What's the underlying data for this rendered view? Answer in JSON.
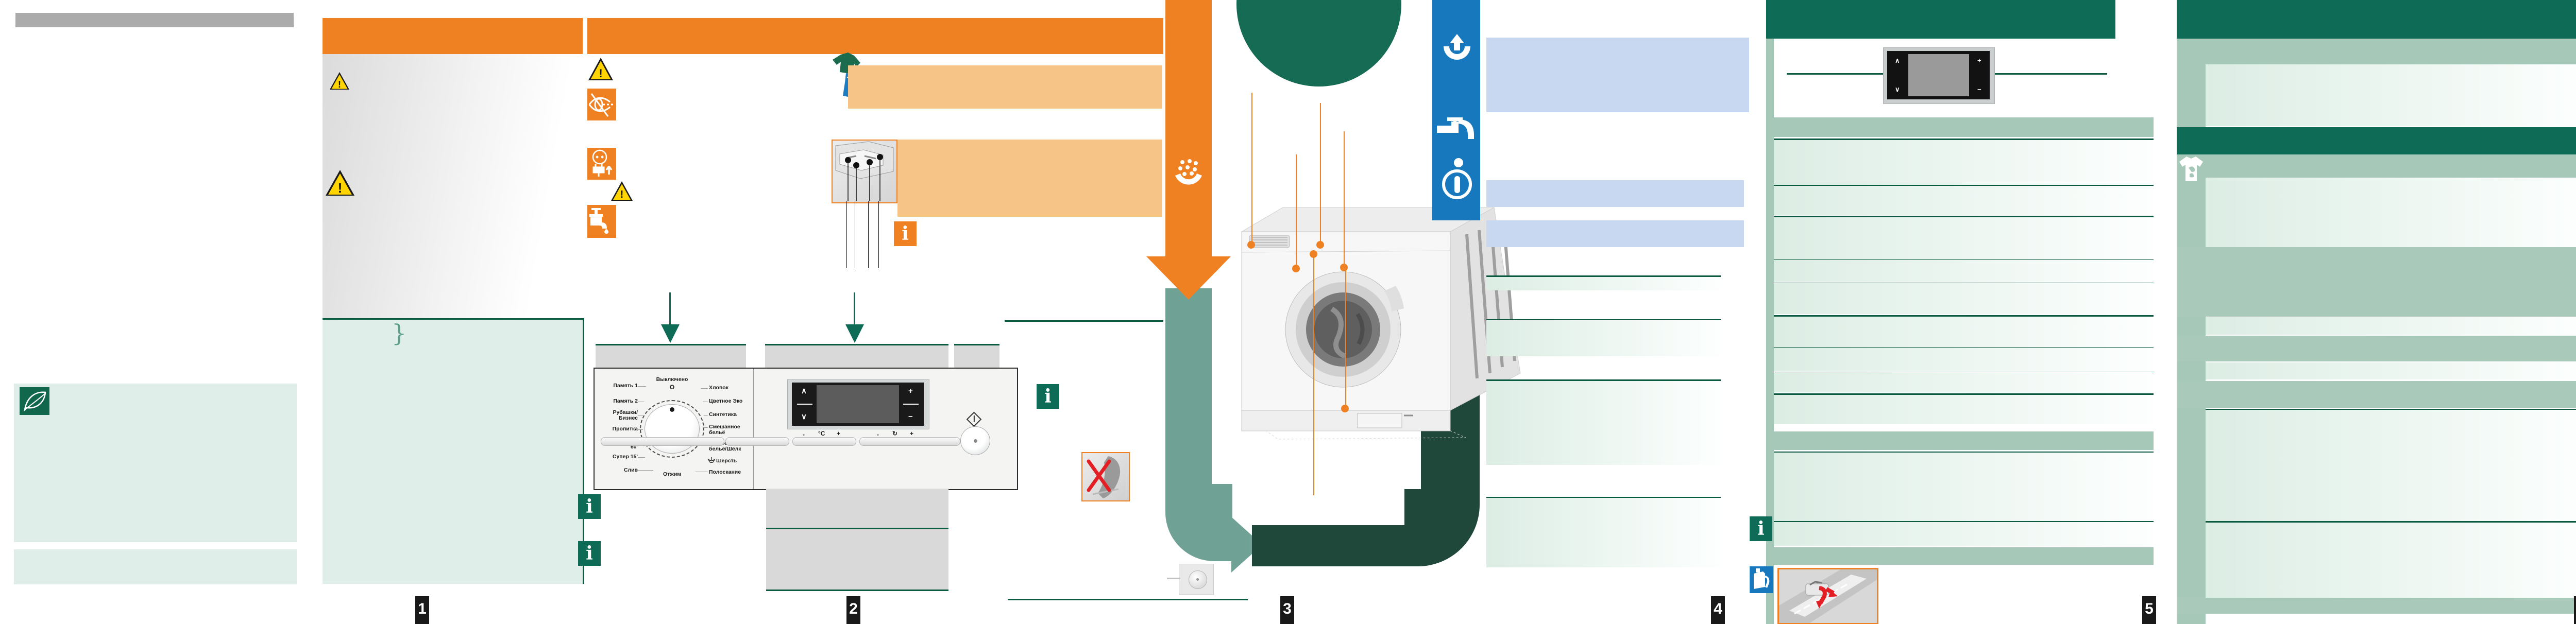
{
  "document": {
    "type": "washing-machine-quick-guide",
    "language": "ru"
  },
  "colors": {
    "orange": "#F08122",
    "light_orange": "#F7C488",
    "dark_green": "#0E6B55",
    "arrow_dark_green": "#20483A",
    "teal": "#6FA195",
    "sage": "#A5C8B8",
    "light_green": "#DFEEE8",
    "blue": "#1878BE",
    "light_blue": "#C8D8F0",
    "red": "#E31E24",
    "yellow": "#FFD400",
    "gray": "#ABABAB",
    "cream": "#FAEFD4"
  },
  "icons": {
    "info": "i",
    "warning": "!",
    "up": "∧",
    "down": "∨",
    "plus": "+",
    "minus": "−",
    "cross": "✕",
    "brace": "}"
  },
  "page_tabs": [
    "1",
    "2",
    "3",
    "4",
    "5",
    "6"
  ],
  "control_panel": {
    "off_label": "Выключено",
    "off_symbol": "O",
    "spin_label": "Отжим",
    "left_programs": [
      "Память 1",
      "Память 2",
      "Рубашки/\nБизнес",
      "Пропитка",
      "Активная\n60'",
      "Супер 15'",
      "Слив"
    ],
    "right_programs": [
      "Хлопок",
      "Цветное Эко",
      "Синтетика",
      "Смешанное\nбельё",
      "Тонкое\nбельё/Шёлк",
      "Шерсть",
      "Полоскание"
    ],
    "temp": {
      "minus": "-",
      "unit": "°C",
      "plus": "+"
    },
    "spin": {
      "minus": "-",
      "symbol": "↻",
      "plus": "+"
    }
  }
}
